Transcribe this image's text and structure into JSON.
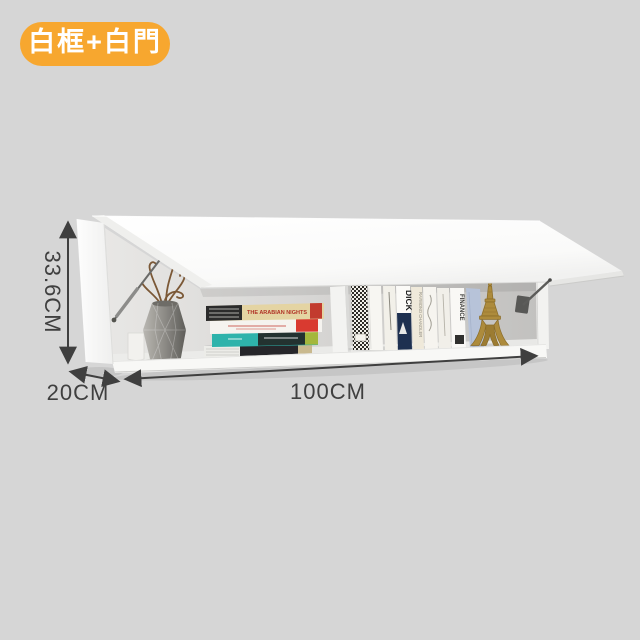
{
  "badge": {
    "label": "白框+白門"
  },
  "colors": {
    "background": "#D6D6D6",
    "badge_bg": "#F7A72F",
    "badge_text": "#FFFFFF",
    "annotation": "#3F3F3F"
  },
  "dimensions": {
    "height": "33.6CM",
    "depth": "20CM",
    "width": "100CM"
  },
  "decor": {
    "stacked_book_title": "THE ARABIAN NIGHTS",
    "spine_moby": "DICK",
    "spine_finance": "FINANCE",
    "spine_chandler": "RAYMOND CHANDLER"
  }
}
